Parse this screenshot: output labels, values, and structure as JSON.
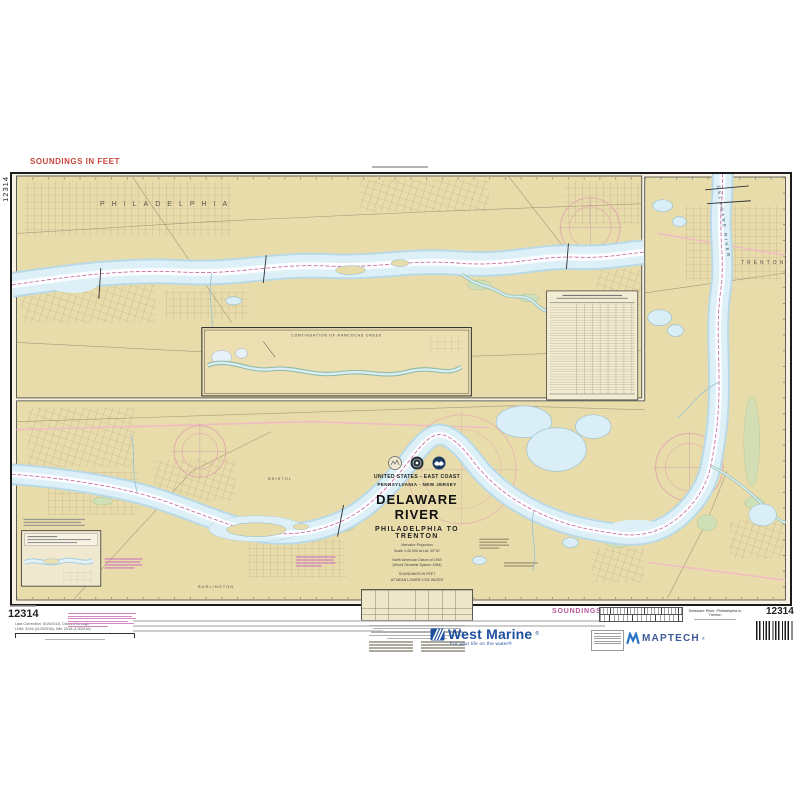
{
  "colors": {
    "accent_red": "#c8473d",
    "magenta": "#b5569b",
    "west_marine_blue": "#1d4f9e",
    "maptech_blue": "#2a72c4",
    "land_tan": "#e9dcab",
    "water_blue": "#d9eef6"
  },
  "margins": {
    "soundings_top": "SOUNDINGS IN FEET",
    "soundings_bottom": "SOUNDINGS IN FEET",
    "chart_no_left": "12314",
    "chart_no_bottom_left": "12314",
    "chart_no_bottom_right": "12314",
    "correction_line1": "Last Correction: 5/19/2018, Cleared through",
    "correction_line2": "LNM: 2016 (11/3/2016); NM: 2016 (1/3/2016)",
    "bottom_right_title": "Delaware River, Philadelphia to Trenton"
  },
  "chart": {
    "labels": {
      "philadelphia": "PHILADELPHIA",
      "trenton": "TRENTON",
      "bristol": "BRISTOL",
      "burlington": "BURLINGTON",
      "delaware_river": "DELAWARE RIVER"
    },
    "inset_title": "CONTINUATION OF RANCOCAS CREEK",
    "title_block": {
      "region_line1": "UNITED STATES - EAST COAST",
      "region_line2": "PENNSYLVANIA - NEW JERSEY",
      "title": "DELAWARE RIVER",
      "subtitle": "PHILADELPHIA TO TRENTON",
      "note1": "Mercator Projection",
      "note2": "Scale 1:40,000 at Lat. 40°10'",
      "note3": "North American Datum of 1983",
      "note4": "(World Geodetic System 1984)",
      "note5": "SOUNDINGS IN FEET",
      "note6": "AT MEAN LOWER LOW WATER"
    }
  },
  "branding": {
    "westmarine_name": "West Marine",
    "westmarine_reg": "®",
    "westmarine_tagline": "For your life on the water®",
    "maptech_name": "MAPTECH",
    "maptech_reg": "®"
  }
}
